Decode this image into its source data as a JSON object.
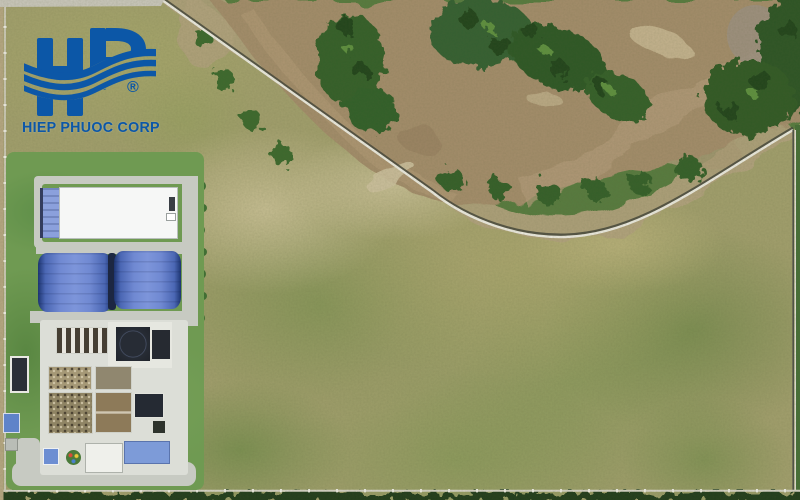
{
  "logo": {
    "monogram": "HP",
    "company": "HIEP PHUOC CORP",
    "registered_mark": "®",
    "brand_color": "#0c57a7"
  },
  "scene": {
    "type": "aerial-drone-photograph",
    "regions": [
      "open grass field",
      "muddy river with bend",
      "riverbank palm vegetation",
      "curved boundary wall",
      "perimeter fence",
      "white-roof warehouse",
      "blue-roof warehouses",
      "wastewater treatment plant basins",
      "access roads",
      "tree hedge along bottom edge"
    ],
    "palette": {
      "field": "#a3a06e",
      "river_water": "#a58e6c",
      "vegetation": "#33602b",
      "mud_bank": "#b3a37e",
      "blue_roof": "#5d7dc9",
      "white_roof": "#f5f6f4",
      "concrete": "#c7cac2",
      "dark_basin": "#252a33"
    }
  }
}
